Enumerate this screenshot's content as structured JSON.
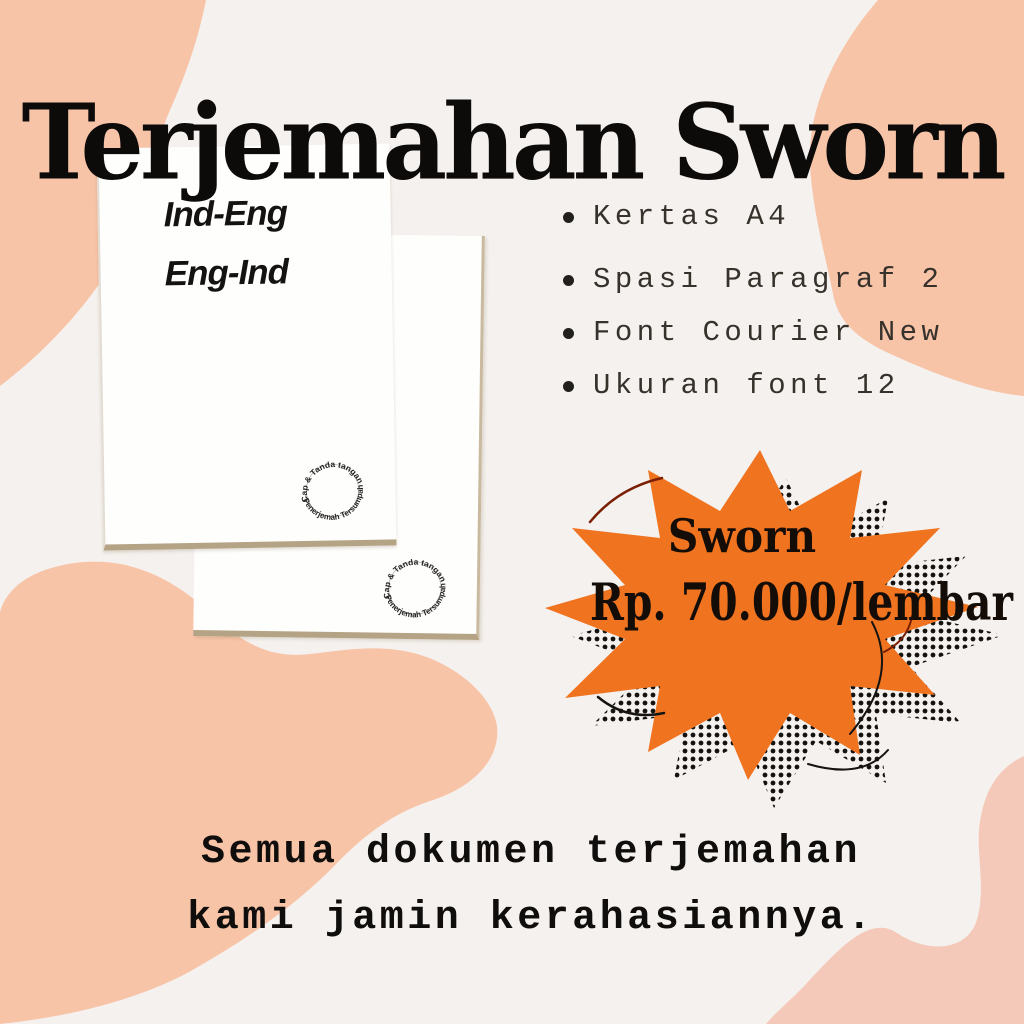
{
  "poster": {
    "title": "Terjemahan Sworn",
    "documents": {
      "front_label_line1": "Ind-Eng",
      "front_label_line2": "Eng-Ind",
      "stamp_arc_top": "Cap & Tanda tangan",
      "stamp_arc_bottom": "Penerjemah Tersumpah"
    },
    "features": [
      {
        "label": "Kertas A4"
      },
      {
        "label": "Spasi Paragraf 2"
      },
      {
        "label": "Font Courier New"
      },
      {
        "label": "Ukuran font 12"
      }
    ],
    "price_burst": {
      "service": "Sworn",
      "price": "Rp. 70.000/lembar"
    },
    "tagline_line1": "Semua dokumen terjemahan",
    "tagline_line2": "kami jamin kerahasiannya.",
    "colors": {
      "background": "#F5F1EE",
      "blob_peach": "#F8C4A8",
      "blob_pink": "#F5C9B9",
      "burst_orange": "#F0731F",
      "paper_edge_tan": "#B5A385",
      "ink": "#0F0E0C"
    }
  }
}
